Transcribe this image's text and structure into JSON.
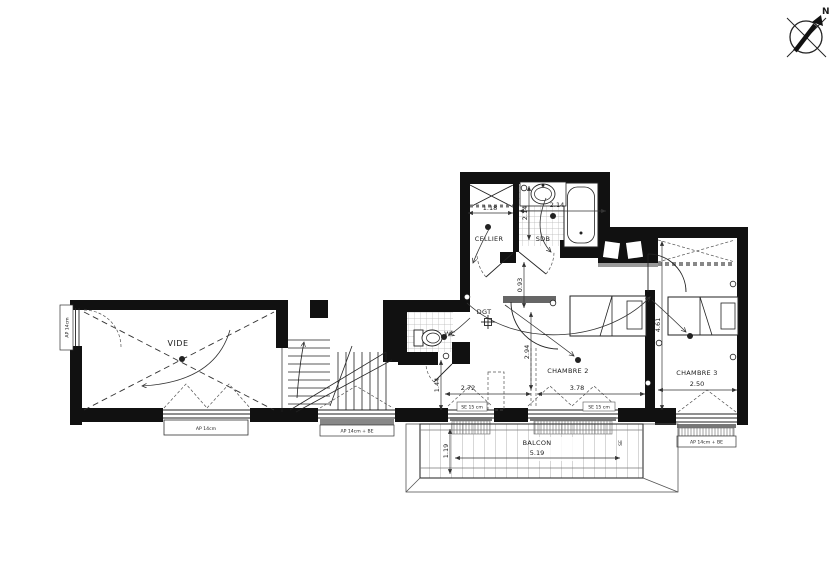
{
  "compass": {
    "north": "N"
  },
  "rooms": {
    "vide": "VIDE",
    "cellier": "CELLIER",
    "sdb": "SDB",
    "wc": "WC",
    "dgt": "DGT",
    "chambre2": "CHAMBRE 2",
    "chambre3": "CHAMBRE 3",
    "balcon": "BALCON"
  },
  "dimensions": {
    "cellier_width": "1.18",
    "sdb_width": "2.14",
    "sdb_height": "2.14",
    "dgt_height": "0.93",
    "entry_width": "2.72",
    "entry_height": "1.44",
    "chambre2_width": "3.78",
    "chambre2_height": "2.94",
    "chambre3_width": "2.50",
    "chambre3_height": "4.61",
    "balcon_width": "5.19",
    "balcon_height": "1.19"
  },
  "windows": {
    "vide_left": "AP 14cm",
    "vide_bottom": "AP 14cm",
    "stair_bottom": "AP 14cm + BE",
    "chambre2_left": "SE 15 cm",
    "chambre2_right": "SE 15 cm",
    "chambre3_bottom": "AP 14cm + BE",
    "balcon_marker": "SE"
  }
}
